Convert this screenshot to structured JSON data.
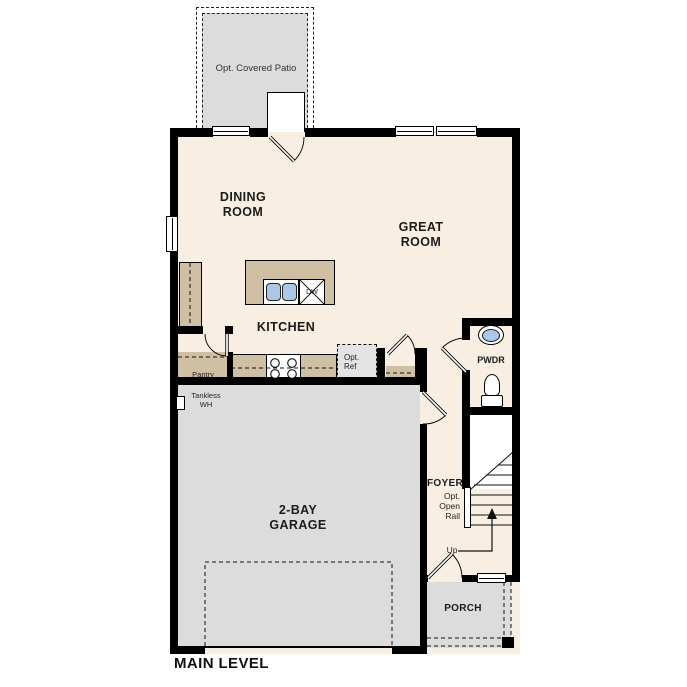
{
  "plan": {
    "title": "MAIN LEVEL",
    "rooms": {
      "patio": "Opt. Covered Patio",
      "dining": "DINING ROOM",
      "great": "GREAT ROOM",
      "kitchen": "KITCHEN",
      "garage": "2-BAY GARAGE",
      "foyer": "FOYER",
      "powder": "PWDR",
      "porch": "PORCH"
    },
    "labels": {
      "pantry": "Pantry",
      "tankless": "Tankless WH",
      "opt_ref": "Opt. Ref",
      "opt_open_rail": "Opt. Open Rail",
      "up": "Up",
      "dishwasher": "DW"
    },
    "colors": {
      "floor": "#f8efe2",
      "concrete": "#dcdcdc",
      "cabinet": "#cfc0a4",
      "fixture_blue": "#aac9e9",
      "wall": "#000000"
    }
  }
}
